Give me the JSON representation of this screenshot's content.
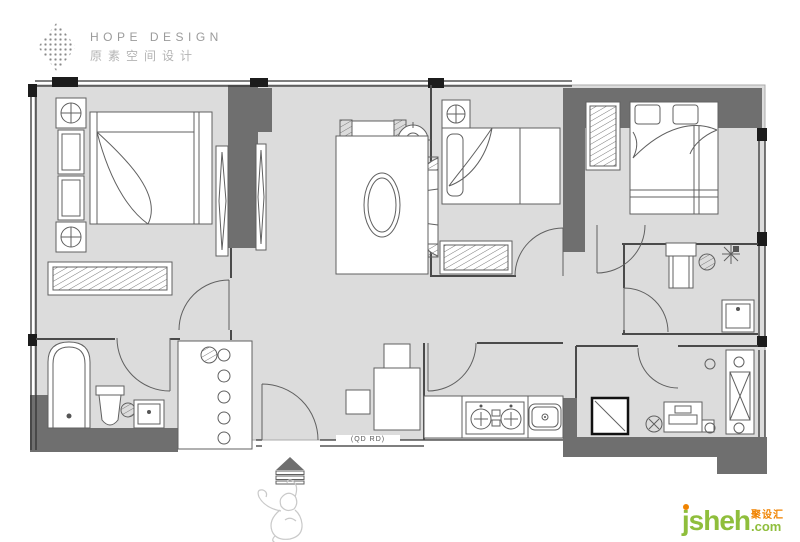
{
  "logo": {
    "title": "HOPE DESIGN",
    "subtitle": "原素空间设计"
  },
  "plan": {
    "door_label": "(QD RD)"
  },
  "watermark": {
    "brand": "jsheh",
    "domain": ".com",
    "badge": "聚设汇"
  },
  "colors": {
    "wall": "#6f6f6f",
    "floor": "#dcdcdc",
    "line": "#606060",
    "green": "#8fbe3c",
    "orange": "#f08300"
  }
}
